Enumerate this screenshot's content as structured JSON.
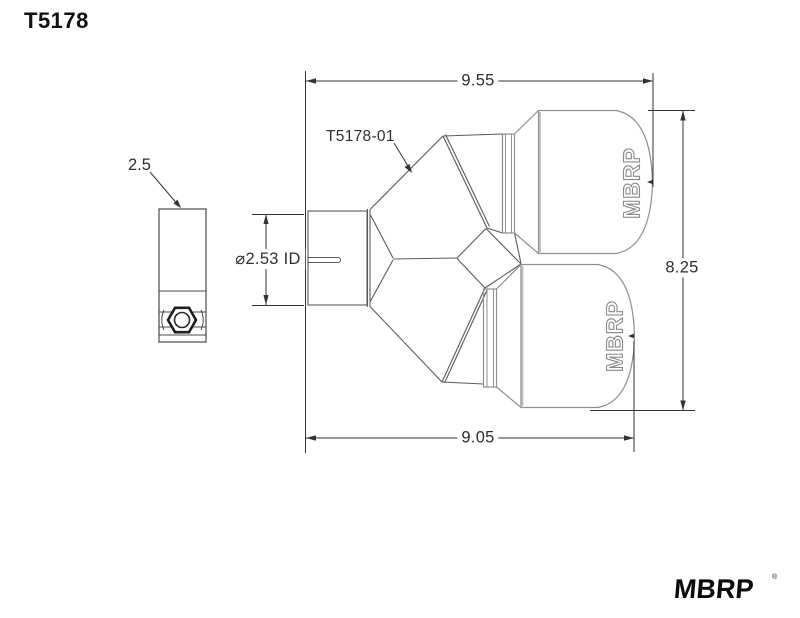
{
  "title": "T5178",
  "drawing": {
    "part_label": "T5178-01",
    "dimensions": {
      "top_width": "9.55",
      "bottom_width": "9.05",
      "overall_height": "8.25",
      "inlet_id": "⌀2.53 ID",
      "clamp_width": "2.5"
    },
    "tip_engraving": "MBRP"
  },
  "branding": {
    "logo": "MBRP",
    "trademark": "®"
  },
  "colors": {
    "background": "#ffffff",
    "dimension_lines": "#333333",
    "part_lines": "#5a5a5a",
    "tip_lines": "#8f8f8f",
    "shading": "#c3c3c3",
    "text": "#2e2e2e"
  }
}
